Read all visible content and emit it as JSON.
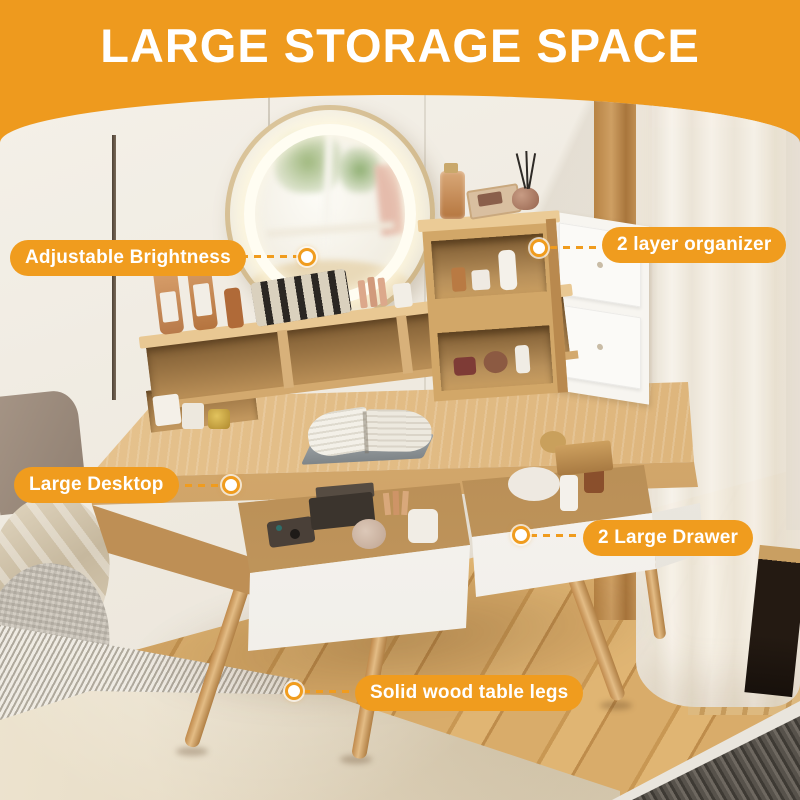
{
  "banner": {
    "title": "LARGE STORAGE SPACE"
  },
  "callouts": [
    {
      "id": "adjustable-brightness",
      "label": "Adjustable Brightness"
    },
    {
      "id": "two-layer-organizer",
      "label": "2 layer organizer"
    },
    {
      "id": "large-desktop",
      "label": "Large Desktop"
    },
    {
      "id": "two-large-drawer",
      "label": "2 Large Drawer"
    },
    {
      "id": "solid-wood-table-legs",
      "label": "Solid wood table legs"
    }
  ],
  "colors": {
    "accent_orange": "#F09C1E",
    "banner_orange": "#EE9A1E",
    "label_text": "#FFFFFF",
    "dot_fill": "#FFFFFF",
    "dot_ring": "#F09C1E"
  }
}
